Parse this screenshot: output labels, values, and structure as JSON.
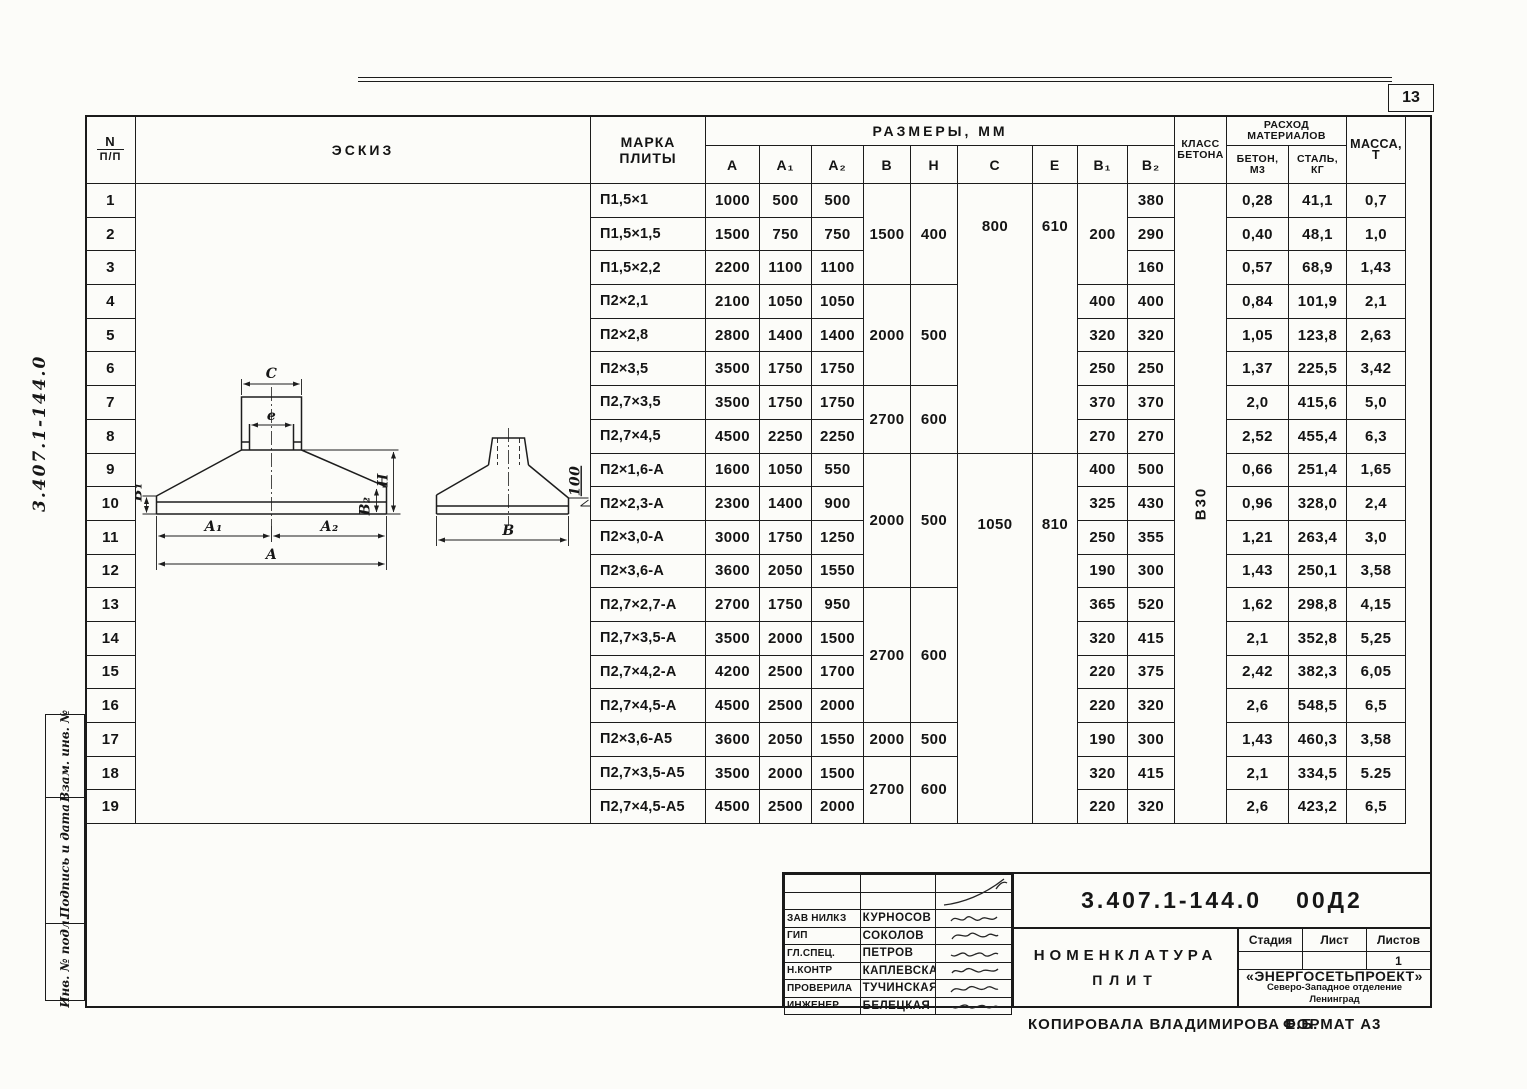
{
  "page": {
    "number": "13",
    "side_code": "3.407.1-144.0",
    "copy_note": "Копировала Владимирова Е.Б.",
    "format_note": "Формат А3"
  },
  "stamp_sidebar": {
    "labels": [
      "Взам. инв. №",
      "Подпись и дата",
      "Инв. № подл."
    ]
  },
  "table": {
    "headers": {
      "num": "N",
      "num2": "п/п",
      "sketch": "Эскиз",
      "marka": "Марка",
      "marka2": "плиты",
      "razmery": "Размеры, мм",
      "sub": [
        "А",
        "А₁",
        "А₂",
        "В",
        "Н",
        "С",
        "е",
        "В₁",
        "В₂"
      ],
      "klass": "Класс",
      "klass2": "бетона",
      "rashod": "Расход",
      "rashod2": "материалов",
      "beton": "Бетон,",
      "beton2": "м3",
      "stal": "Сталь,",
      "stal2": "кг",
      "massa": "Масса,",
      "massa2": "т"
    },
    "rows": [
      {
        "n": "1",
        "marka": "П1,5×1",
        "a": "1000",
        "a1": "500",
        "a2": "500",
        "b1": "",
        "b2": "380",
        "beton": "0,28",
        "stal": "41,1",
        "massa": "0,7"
      },
      {
        "n": "2",
        "marka": "П1,5×1,5",
        "a": "1500",
        "a1": "750",
        "a2": "750",
        "b1": "",
        "b2": "290",
        "beton": "0,40",
        "stal": "48,1",
        "massa": "1,0"
      },
      {
        "n": "3",
        "marka": "П1,5×2,2",
        "a": "2200",
        "a1": "1100",
        "a2": "1100",
        "b1": "",
        "b2": "160",
        "beton": "0,57",
        "stal": "68,9",
        "massa": "1,43"
      },
      {
        "n": "4",
        "marka": "П2×2,1",
        "a": "2100",
        "a1": "1050",
        "a2": "1050",
        "b1": "400",
        "b2": "400",
        "beton": "0,84",
        "stal": "101,9",
        "massa": "2,1"
      },
      {
        "n": "5",
        "marka": "П2×2,8",
        "a": "2800",
        "a1": "1400",
        "a2": "1400",
        "b1": "320",
        "b2": "320",
        "beton": "1,05",
        "stal": "123,8",
        "massa": "2,63"
      },
      {
        "n": "6",
        "marka": "П2×3,5",
        "a": "3500",
        "a1": "1750",
        "a2": "1750",
        "b1": "250",
        "b2": "250",
        "beton": "1,37",
        "stal": "225,5",
        "massa": "3,42"
      },
      {
        "n": "7",
        "marka": "П2,7×3,5",
        "a": "3500",
        "a1": "1750",
        "a2": "1750",
        "b1": "370",
        "b2": "370",
        "beton": "2,0",
        "stal": "415,6",
        "massa": "5,0"
      },
      {
        "n": "8",
        "marka": "П2,7×4,5",
        "a": "4500",
        "a1": "2250",
        "a2": "2250",
        "b1": "270",
        "b2": "270",
        "beton": "2,52",
        "stal": "455,4",
        "massa": "6,3"
      },
      {
        "n": "9",
        "marka": "П2×1,6-А",
        "a": "1600",
        "a1": "1050",
        "a2": "550",
        "b1": "400",
        "b2": "500",
        "beton": "0,66",
        "stal": "251,4",
        "massa": "1,65"
      },
      {
        "n": "10",
        "marka": "П2×2,3-А",
        "a": "2300",
        "a1": "1400",
        "a2": "900",
        "b1": "325",
        "b2": "430",
        "beton": "0,96",
        "stal": "328,0",
        "massa": "2,4"
      },
      {
        "n": "11",
        "marka": "П2×3,0-А",
        "a": "3000",
        "a1": "1750",
        "a2": "1250",
        "b1": "250",
        "b2": "355",
        "beton": "1,21",
        "stal": "263,4",
        "massa": "3,0"
      },
      {
        "n": "12",
        "marka": "П2×3,6-А",
        "a": "3600",
        "a1": "2050",
        "a2": "1550",
        "b1": "190",
        "b2": "300",
        "beton": "1,43",
        "stal": "250,1",
        "massa": "3,58"
      },
      {
        "n": "13",
        "marka": "П2,7×2,7-А",
        "a": "2700",
        "a1": "1750",
        "a2": "950",
        "b1": "365",
        "b2": "520",
        "beton": "1,62",
        "stal": "298,8",
        "massa": "4,15"
      },
      {
        "n": "14",
        "marka": "П2,7×3,5-А",
        "a": "3500",
        "a1": "2000",
        "a2": "1500",
        "b1": "320",
        "b2": "415",
        "beton": "2,1",
        "stal": "352,8",
        "massa": "5,25"
      },
      {
        "n": "15",
        "marka": "П2,7×4,2-А",
        "a": "4200",
        "a1": "2500",
        "a2": "1700",
        "b1": "220",
        "b2": "375",
        "beton": "2,42",
        "stal": "382,3",
        "massa": "6,05"
      },
      {
        "n": "16",
        "marka": "П2,7×4,5-А",
        "a": "4500",
        "a1": "2500",
        "a2": "2000",
        "b1": "220",
        "b2": "320",
        "beton": "2,6",
        "stal": "548,5",
        "massa": "6,5"
      },
      {
        "n": "17",
        "marka": "П2×3,6-А5",
        "a": "3600",
        "a1": "2050",
        "a2": "1550",
        "b1": "190",
        "b2": "300",
        "beton": "1,43",
        "stal": "460,3",
        "massa": "3,58"
      },
      {
        "n": "18",
        "marka": "П2,7×3,5-А5",
        "a": "3500",
        "a1": "2000",
        "a2": "1500",
        "b1": "320",
        "b2": "415",
        "beton": "2,1",
        "stal": "334,5",
        "massa": "5.25"
      },
      {
        "n": "19",
        "marka": "П2,7×4,5-А5",
        "a": "4500",
        "a1": "2500",
        "a2": "2000",
        "b1": "220",
        "b2": "320",
        "beton": "2,6",
        "stal": "423,2",
        "massa": "6,5"
      }
    ],
    "merged": {
      "b": [
        {
          "start": 0,
          "span": 3,
          "v": "1500"
        },
        {
          "start": 3,
          "span": 3,
          "v": "2000"
        },
        {
          "start": 6,
          "span": 2,
          "v": "2700"
        },
        {
          "start": 8,
          "span": 4,
          "v": "2000"
        },
        {
          "start": 12,
          "span": 4,
          "v": "2700"
        },
        {
          "start": 16,
          "span": 1,
          "v": "2000"
        },
        {
          "start": 17,
          "span": 2,
          "v": "2700"
        }
      ],
      "h": [
        {
          "start": 0,
          "span": 3,
          "v": "400"
        },
        {
          "start": 3,
          "span": 3,
          "v": "500"
        },
        {
          "start": 6,
          "span": 2,
          "v": "600"
        },
        {
          "start": 8,
          "span": 4,
          "v": "500"
        },
        {
          "start": 12,
          "span": 4,
          "v": "600"
        },
        {
          "start": 16,
          "span": 1,
          "v": "500"
        },
        {
          "start": 17,
          "span": 2,
          "v": "600"
        }
      ],
      "c": [
        {
          "start": 0,
          "span": 8,
          "v": "800"
        },
        {
          "start": 8,
          "span": 11,
          "v": "1050"
        }
      ],
      "e": [
        {
          "start": 0,
          "span": 8,
          "v": "610"
        },
        {
          "start": 8,
          "span": 11,
          "v": "810"
        }
      ],
      "b1_first": "200",
      "klass": "В30"
    }
  },
  "sketch": {
    "labels": {
      "c": "С",
      "e": "е",
      "b1": "В₁",
      "b2": "В₂",
      "h": "Н",
      "a1": "А₁",
      "a2": "А₂",
      "a": "А",
      "b": "В",
      "slope": "100"
    }
  },
  "titleblock": {
    "doc_number": "3.407.1-144.0",
    "doc_suffix": "00Д2",
    "title_line1": "Номенклатура",
    "title_line2": "плит",
    "rows": [
      {
        "role": "Зав НИЛКЗ",
        "name": "Курносов"
      },
      {
        "role": "ГИП",
        "name": "Соколов"
      },
      {
        "role": "Гл.спец.",
        "name": "Петров"
      },
      {
        "role": "Н.контр",
        "name": "Каплевская"
      },
      {
        "role": "Проверила",
        "name": "Тучинская"
      },
      {
        "role": "Инженер",
        "name": "Белецкая"
      }
    ],
    "stage_label": "Стадия",
    "sheet_label": "Лист",
    "sheets_label": "Листов",
    "sheets_value": "1",
    "org_line1": "«ЭНЕРГОСЕТЬПРОЕКТ»",
    "org_line2": "Северо-Западное отделение",
    "org_line3": "Ленинград"
  }
}
